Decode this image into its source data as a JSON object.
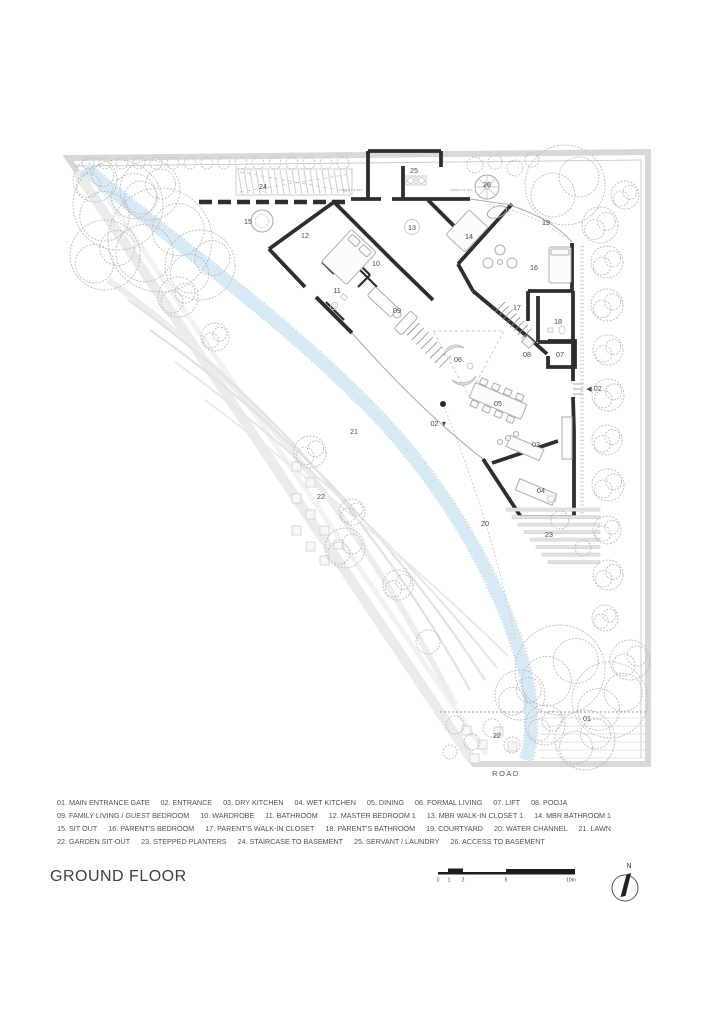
{
  "title": "GROUND FLOOR",
  "road_label": "ROAD",
  "north": {
    "label": "N"
  },
  "scale": {
    "unit_labels": [
      "0",
      "1",
      "2",
      "5",
      "10m"
    ],
    "tick_x": [
      438,
      449,
      463,
      506,
      571
    ]
  },
  "colors": {
    "wall": "#2e2e2e",
    "water-fill": "#d7e9f4",
    "water-edge": "#bfd7e6",
    "tree": "#bcbcbc",
    "boundary": "#d8d8d8",
    "label": "#4a4a4a",
    "title": "#3e3e3e",
    "legend": "#505050",
    "scalebar": "#1c1c1c"
  },
  "legend": {
    "rows": [
      [
        {
          "no": "01",
          "label": "MAIN ENTRANCE GATE"
        },
        {
          "no": "02",
          "label": "ENTRANCE"
        },
        {
          "no": "03",
          "label": "DRY KITCHEN"
        },
        {
          "no": "04",
          "label": "WET KITCHEN"
        },
        {
          "no": "05",
          "label": "DINING"
        },
        {
          "no": "06",
          "label": "FORMAL LIVING"
        },
        {
          "no": "07",
          "label": "LIFT"
        },
        {
          "no": "08",
          "label": "POOJA"
        }
      ],
      [
        {
          "no": "09",
          "label": "FAMILY LIVING / GUEST BEDROOM"
        },
        {
          "no": "10",
          "label": "WARDROBE"
        },
        {
          "no": "11",
          "label": "BATHROOM"
        },
        {
          "no": "12",
          "label": "MASTER BEDROOM 1"
        },
        {
          "no": "13",
          "label": "MBR WALK-IN CLOSET 1"
        },
        {
          "no": "14",
          "label": "MBR BATHROOM 1"
        }
      ],
      [
        {
          "no": "15",
          "label": "SIT OUT"
        },
        {
          "no": "16",
          "label": "PARENT'S BEDROOM"
        },
        {
          "no": "17",
          "label": "PARENT'S WALK-IN CLOSET"
        },
        {
          "no": "18",
          "label": "PARENT'S BATHROOM"
        },
        {
          "no": "19",
          "label": "COURTYARD"
        },
        {
          "no": "20",
          "label": "WATER CHANNEL"
        },
        {
          "no": "21",
          "label": "LAWN"
        }
      ],
      [
        {
          "no": "22",
          "label": "GARDEN SIT-OUT"
        },
        {
          "no": "23",
          "label": "STEPPED PLANTERS"
        },
        {
          "no": "24",
          "label": "STAIRCASE TO BASEMENT"
        },
        {
          "no": "25",
          "label": "SERVANT / LAUNDRY"
        },
        {
          "no": "26",
          "label": "ACCESS TO BASEMENT"
        }
      ]
    ]
  },
  "plan": {
    "labels": [
      {
        "t": "24",
        "x": 263,
        "y": 189
      },
      {
        "t": "25",
        "x": 414,
        "y": 173
      },
      {
        "t": "26",
        "x": 487,
        "y": 187
      },
      {
        "t": "OPEN TO SKY",
        "x": 352,
        "y": 191,
        "fs": 2.8
      },
      {
        "t": "OPEN TO SKY",
        "x": 462,
        "y": 191,
        "fs": 2.8
      },
      {
        "t": "15",
        "x": 248,
        "y": 224
      },
      {
        "t": "12",
        "x": 305,
        "y": 238
      },
      {
        "t": "13",
        "x": 412,
        "y": 230
      },
      {
        "t": "14",
        "x": 469,
        "y": 239
      },
      {
        "t": "19",
        "x": 546,
        "y": 225
      },
      {
        "t": "10",
        "x": 376,
        "y": 266
      },
      {
        "t": "16",
        "x": 534,
        "y": 270
      },
      {
        "t": "11",
        "x": 337,
        "y": 293
      },
      {
        "t": "09",
        "x": 397,
        "y": 313
      },
      {
        "t": "17",
        "x": 517,
        "y": 310
      },
      {
        "t": "18",
        "x": 558,
        "y": 324
      },
      {
        "t": "08",
        "x": 527,
        "y": 357
      },
      {
        "t": "07",
        "x": 560,
        "y": 357
      },
      {
        "t": "06",
        "x": 458,
        "y": 362
      },
      {
        "t": "◀ 02",
        "x": 594,
        "y": 391
      },
      {
        "t": "05",
        "x": 498,
        "y": 406
      },
      {
        "t": "02 ▼",
        "x": 439,
        "y": 426
      },
      {
        "t": "21",
        "x": 354,
        "y": 434
      },
      {
        "t": "03",
        "x": 536,
        "y": 447
      },
      {
        "t": "04",
        "x": 541,
        "y": 493
      },
      {
        "t": "22",
        "x": 321,
        "y": 499
      },
      {
        "t": "20",
        "x": 485,
        "y": 526
      },
      {
        "t": "23",
        "x": 549,
        "y": 537
      },
      {
        "t": "01",
        "x": 587,
        "y": 721
      },
      {
        "t": "22",
        "x": 497,
        "y": 738
      }
    ]
  }
}
